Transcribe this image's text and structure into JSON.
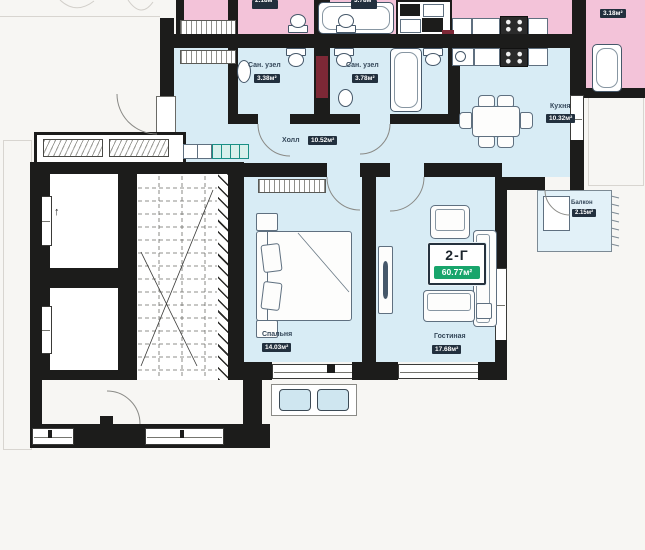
{
  "colors": {
    "pink": "#f3c3d9",
    "blue": "#d8ecf5",
    "balcony_blue": "#e2f1f8",
    "wall": "#1c1c1b",
    "wall_red": "#7d2836",
    "badge_bg": "#22303e",
    "unit_green": "#18a56c",
    "teal": "#1a8f85"
  },
  "unit": {
    "id": "2-Г",
    "area": "60.77м²"
  },
  "rooms": {
    "hall": {
      "name": "Холл",
      "area": "10.52м²"
    },
    "bath_small": {
      "name": "Сан. узел",
      "area": "3.38м²"
    },
    "bath_large": {
      "name": "Сан. узел",
      "area": "3.78м²"
    },
    "kitchen": {
      "name": "Кухня",
      "area": "10.32м²"
    },
    "bedroom": {
      "name": "Спальня",
      "area": "14.03м²"
    },
    "living_room": {
      "name": "Гостиная",
      "area": "17.68м²"
    },
    "balcony": {
      "name": "Балкон",
      "area": "2.15м²"
    }
  },
  "neighbor_unit_badges": {
    "left": "2.18м²",
    "middle": "3.78м²",
    "right": "3.18м²"
  },
  "elevator": {
    "direction_arrow": "↑"
  }
}
